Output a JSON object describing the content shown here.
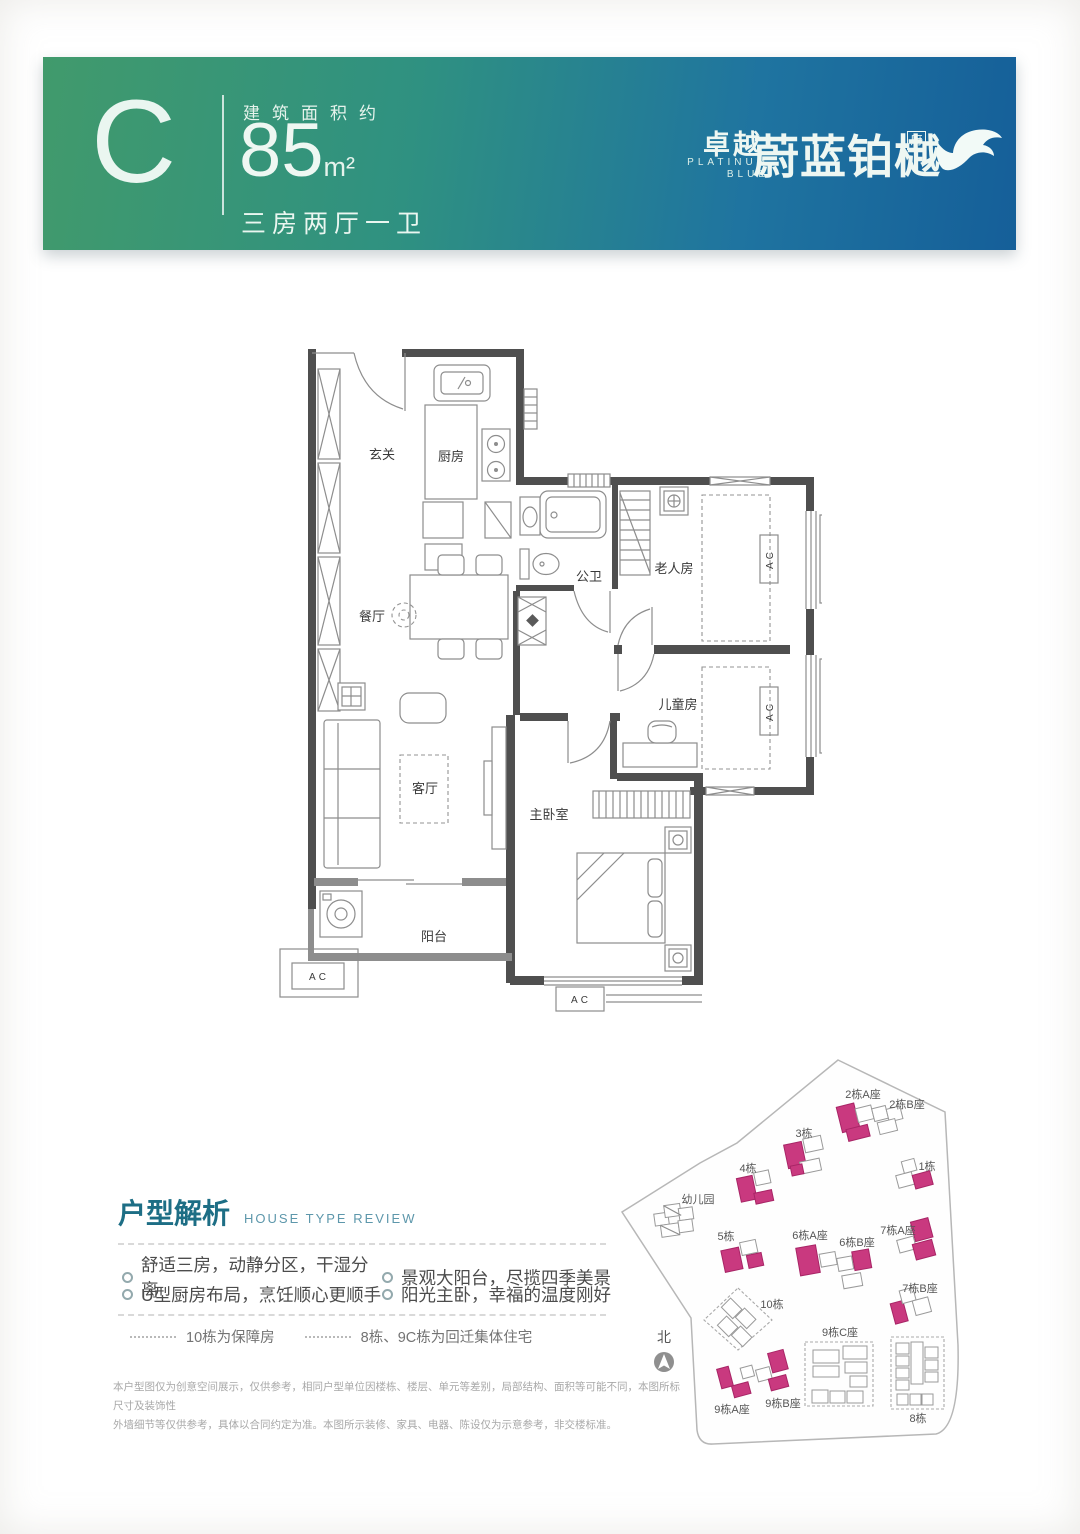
{
  "banner": {
    "unit_letter": "C",
    "area_prefix": "建筑面积约",
    "area_value": "85",
    "area_unit": "m²",
    "layout_text": "三房两厅一卫",
    "brand_cn": "卓越",
    "brand_en_line1": "PLATINUM",
    "brand_en_line2": "BLUE",
    "project_name": "蔚蓝铂樾",
    "project_suffix": "府",
    "colors": {
      "gradient_left": "#419a6c",
      "gradient_mid": "#2f9181",
      "gradient_right": "#155f99"
    }
  },
  "floor_plan": {
    "rooms": {
      "entry": "玄关",
      "kitchen": "厨房",
      "dining": "餐厅",
      "bath": "公卫",
      "elder_room": "老人房",
      "kids_room": "儿童房",
      "living": "客厅",
      "master": "主卧室",
      "balcony": "阳台"
    },
    "ac_label": "AC"
  },
  "review": {
    "title_cn": "户型解析",
    "title_en": "HOUSE TYPE REVIEW",
    "bullets": [
      "舒适三房，动静分区，干湿分离",
      "景观大阳台，尽揽四季美景",
      "U型厨房布局，烹饪顺心更顺手",
      "阳光主卧，幸福的温度刚好"
    ],
    "legend": [
      "10栋为保障房",
      "8栋、9C栋为回迁集体住宅"
    ],
    "disclaimer_line1": "本户型图仅为创意空间展示，仅供参考，相同户型单位因楼栋、楼层、单元等差别，局部结构、面积等可能不同，本图所标尺寸及装饰性",
    "disclaimer_line2": "外墙细节等仅供参考，具体以合同约定为准。本图所示装修、家具、电器、陈设仅为示意参考，非交楼标准。"
  },
  "site_plan": {
    "north_label": "北",
    "highlight_color": "#c9397f",
    "buildings": {
      "kindergarten": "幼儿园",
      "b1": "1栋",
      "b2a": "2栋A座",
      "b2b": "2栋B座",
      "b3": "3栋",
      "b4": "4栋",
      "b5": "5栋",
      "b6a": "6栋A座",
      "b6b": "6栋B座",
      "b7a": "7栋A座",
      "b7b": "7栋B座",
      "b8": "8栋",
      "b9a": "9栋A座",
      "b9b": "9栋B座",
      "b9c": "9栋C座",
      "b10": "10栋"
    }
  }
}
